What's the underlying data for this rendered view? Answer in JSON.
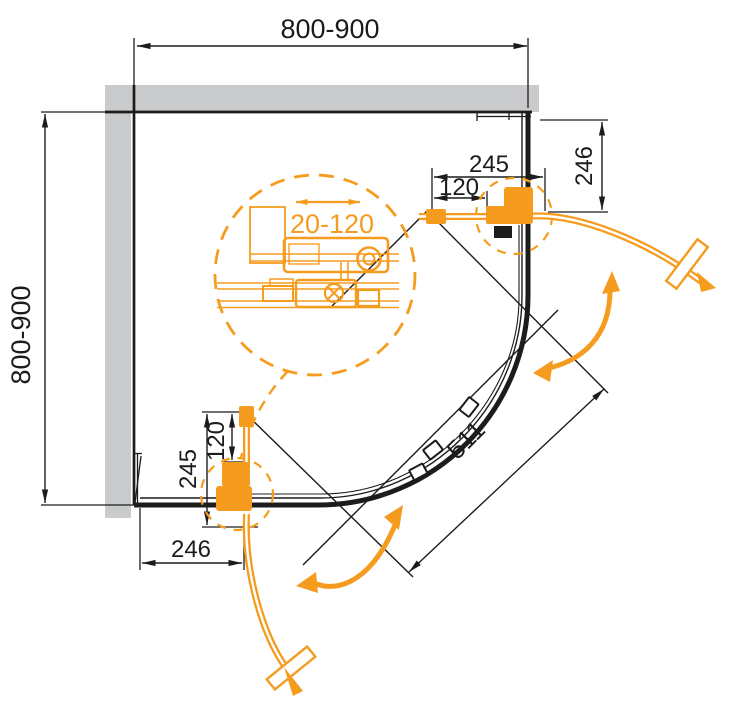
{
  "drawing": {
    "description": "quadrant corner shower enclosure - top view technical plan",
    "colors": {
      "accent_orange": "#F59C1F",
      "wall_gray": "#CACBCC",
      "line_black": "#1C1C1C"
    },
    "dims": {
      "top_width": "800-900",
      "left_height": "800-900",
      "tr_hinge": "245",
      "tr_handle": "120",
      "tr_wall": "246",
      "bl_hinge": "245",
      "bl_handle": "120",
      "bl_wall": "246",
      "diagonal_opening": "511",
      "adjust_range": "20-120"
    }
  }
}
